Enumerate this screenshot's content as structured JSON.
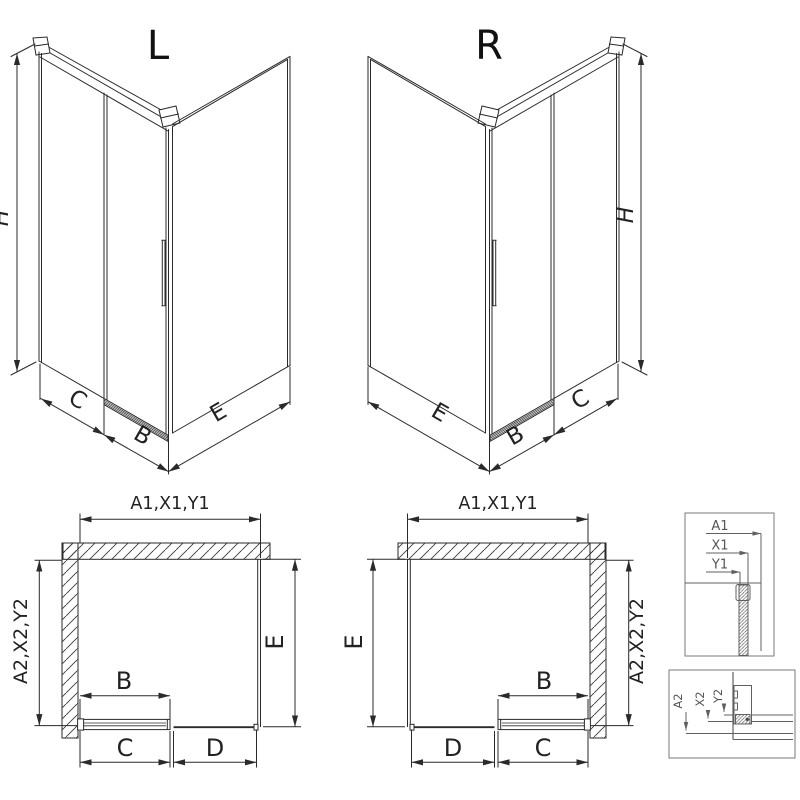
{
  "drawing": {
    "variant_labels": {
      "left": "L",
      "right": "R"
    },
    "dimensions": {
      "height": "H",
      "fixed_panel": "C",
      "door_width": "B",
      "side_panel": "E",
      "second_fixed": "D",
      "top_combined": "A1,X1,Y1",
      "side_combined": "A2,X2,Y2"
    },
    "detail_sections": {
      "top_labels": [
        "A1",
        "X1",
        "Y1"
      ],
      "bottom_labels": [
        "A2",
        "X2",
        "Y2"
      ]
    },
    "colors": {
      "line": "#2a2a2a",
      "detail_line": "#606060",
      "background": "#ffffff"
    }
  }
}
